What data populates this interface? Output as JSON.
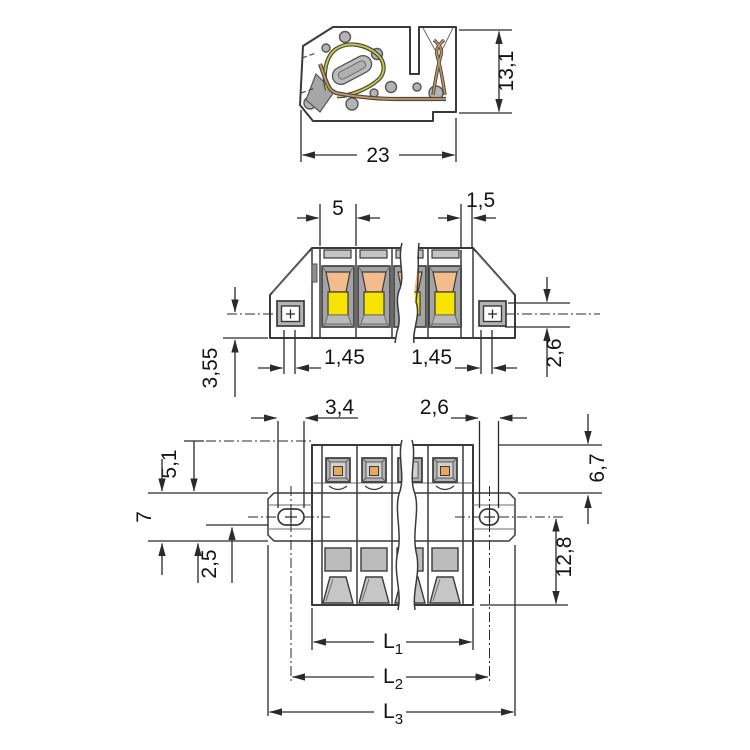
{
  "title": "connector-dimensional-drawing",
  "colors": {
    "body_gray": "#b4b4b4",
    "recess_gray": "#a4a4a4",
    "light_gray": "#d2d2d2",
    "outline": "#3a3a3a",
    "yellow": "#f6e400",
    "orange_window": "#f2bc8d",
    "orange_contact": "#eaa55e",
    "copper": "#c6945c",
    "spring_green": "#c6cc3c",
    "white": "#ffffff"
  },
  "views": {
    "side_section": {
      "dim_height": "13,1",
      "dim_width": "23"
    },
    "front": {
      "dim_pitch": "5",
      "dim_wall": "1,5",
      "dim_offset_left": "1,45",
      "dim_offset_right": "1,45",
      "dim_flange_height": "2,6",
      "dim_bottom_to_center": "3,55"
    },
    "top": {
      "dim_slot_left": "3,4",
      "dim_slot_right": "2,6",
      "dim_top_to_flange_left": "5,1",
      "dim_flange_width": "7",
      "dim_flange_offset": "2,5",
      "dim_top_to_flange_right": "6,7",
      "dim_center_to_bottom": "12,8",
      "lengths": [
        {
          "symbol": "L",
          "sub": "1"
        },
        {
          "symbol": "L",
          "sub": "2"
        },
        {
          "symbol": "L",
          "sub": "3"
        }
      ]
    }
  }
}
